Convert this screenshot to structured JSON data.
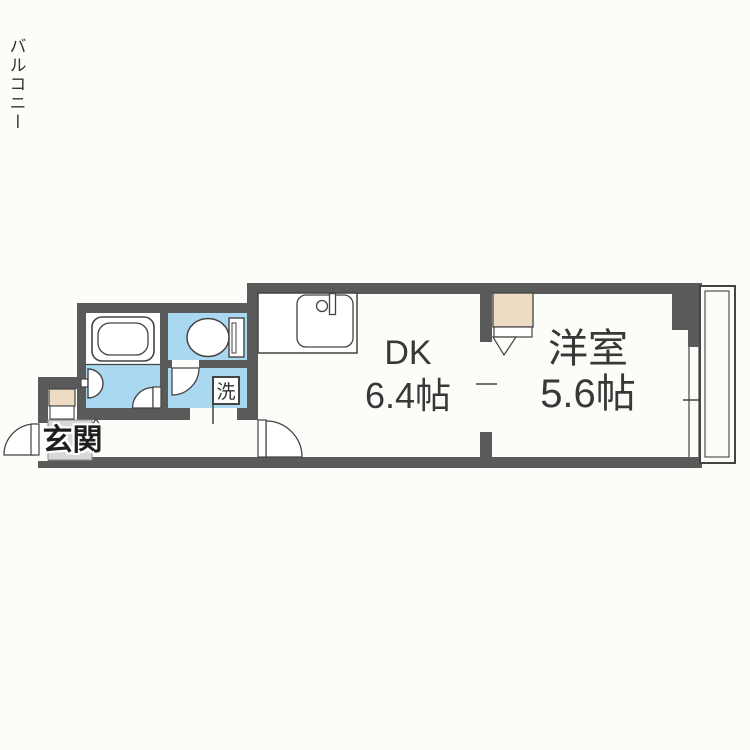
{
  "floor_plan": {
    "entrance": {
      "label": "玄関"
    },
    "laundry": {
      "label": "洗"
    },
    "dining_kitchen": {
      "label": "DK",
      "size": "6.4帖"
    },
    "western_room": {
      "label": "洋室",
      "size": "5.6帖"
    },
    "balcony": {
      "label": "バルコニー"
    },
    "fixtures": [
      "bathtub",
      "wash-basin",
      "toilet",
      "kitchen-sink",
      "shoe-cabinet",
      "closet",
      "washing-machine-space"
    ],
    "colors": {
      "wall": "#5a5a5a",
      "water_rooms": "#a9d8f0",
      "closet_fill": "#eddcc3",
      "entrance_floor": "#d9d9d9",
      "outline": "#434343",
      "background": "#fcfcf9",
      "text": "#383838"
    }
  }
}
